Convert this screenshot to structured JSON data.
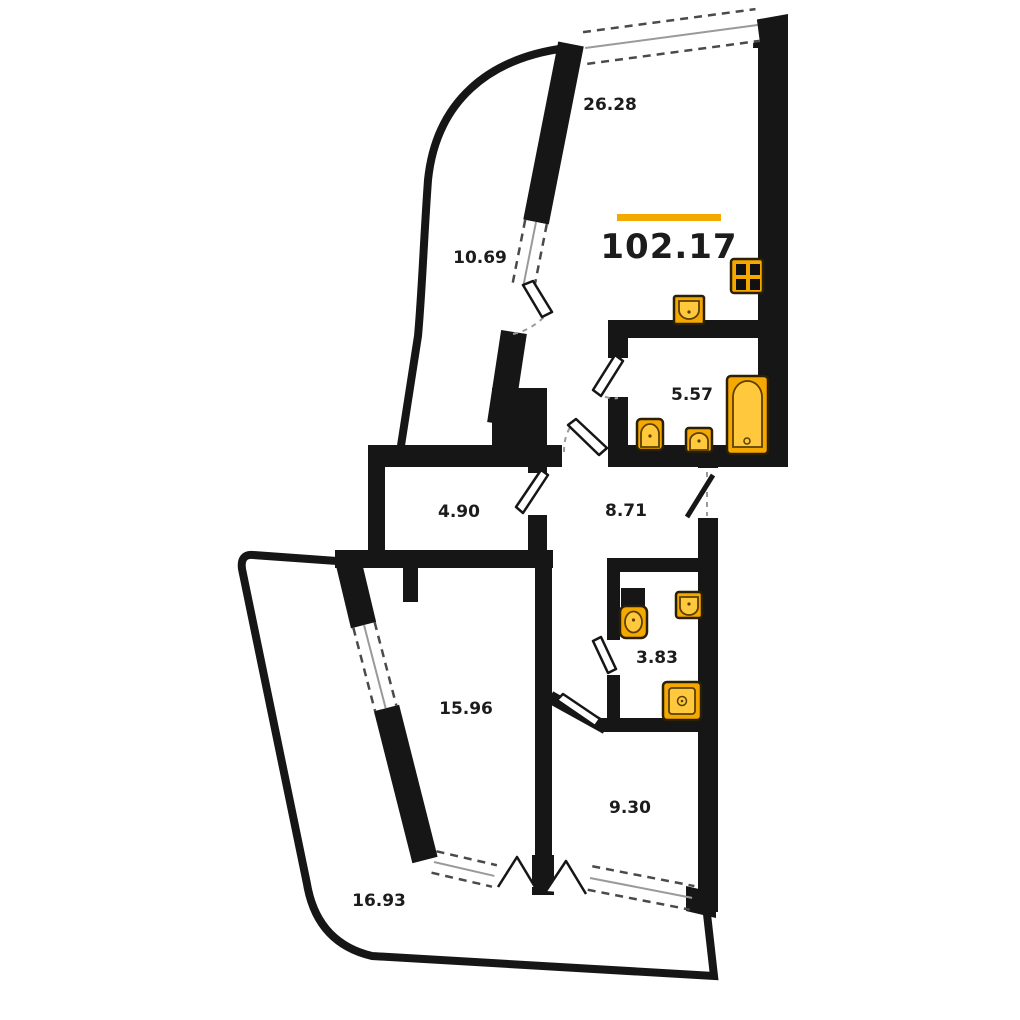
{
  "plan_title": "apartment-floor-plan",
  "total": {
    "value": "102.17"
  },
  "rooms": [
    {
      "name": "living-kitchen",
      "area": "26.28"
    },
    {
      "name": "balcony-top",
      "area": "10.69"
    },
    {
      "name": "bathroom",
      "area": "5.57"
    },
    {
      "name": "storage",
      "area": "4.90"
    },
    {
      "name": "hallway",
      "area": "8.71"
    },
    {
      "name": "wc",
      "area": "3.83"
    },
    {
      "name": "bedroom",
      "area": "15.96"
    },
    {
      "name": "room",
      "area": "9.30"
    },
    {
      "name": "balcony-bottom",
      "area": "16.93"
    }
  ],
  "colors": {
    "wall": "#161616",
    "accent": "#F2A900",
    "fixture": "#F5A800",
    "fixture_light": "#FFC83D",
    "background": "#ffffff"
  },
  "fixtures": [
    "stove",
    "kitchen-sink",
    "bathtub",
    "toilet",
    "sink",
    "shower"
  ]
}
